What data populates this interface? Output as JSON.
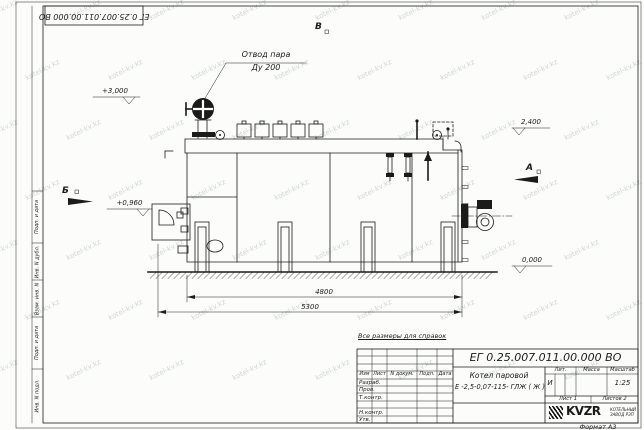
{
  "frame": {
    "top_stamp": "ЕГ 0.25.007.011.00.000  ВО",
    "side_labels": [
      "Подп. и дата",
      "Инв. N дубл.",
      "Взам. инв. N",
      "Подп. и дата",
      "Инв. N подл."
    ],
    "format": "Формат А3",
    "watermark": "kotel-kv.kz"
  },
  "drawing": {
    "note": "Все размеры для справок",
    "leader_line1": "Отвод пара",
    "leader_line2": "Ду 200",
    "elev_top_left": "+3,000",
    "elev_burner": "+0,960",
    "elev_top_right": "2,400",
    "elev_ground": "0,000",
    "dim_inner": "4800",
    "dim_outer": "5300",
    "section_b": "Б",
    "section_a": "А",
    "section_v": "В"
  },
  "titleblock": {
    "doc_number": "ЕГ 0.25.007.011.00.000  ВО",
    "product_line1": "Котел паровой",
    "product_line2": "Е -2,5-0,07-115- ГЛЖ ( Ж )",
    "col_izm": "Изм",
    "col_list": "Лист",
    "col_ndoc": "N докум.",
    "col_podp": "Подп.",
    "col_data": "Дата",
    "row_razrab": "Разраб.",
    "row_prov": "Пров.",
    "row_tkontr": "Т.контр.",
    "row_nkontr": "Н.контр.",
    "row_utv": "Утв.",
    "h_lit": "Лит.",
    "h_massa": "Масса",
    "h_scale": "Масштаб",
    "lit_value": "И",
    "scale_value": "1:25",
    "sheet_label": "Лист",
    "sheet_value": "1",
    "sheets_label": "Листов",
    "sheets_value": "2",
    "logo_text": "KVZR",
    "logo_sub1": "КОТЕЛЬНЫЙ",
    "logo_sub2": "ЗАВОД РЭП"
  }
}
